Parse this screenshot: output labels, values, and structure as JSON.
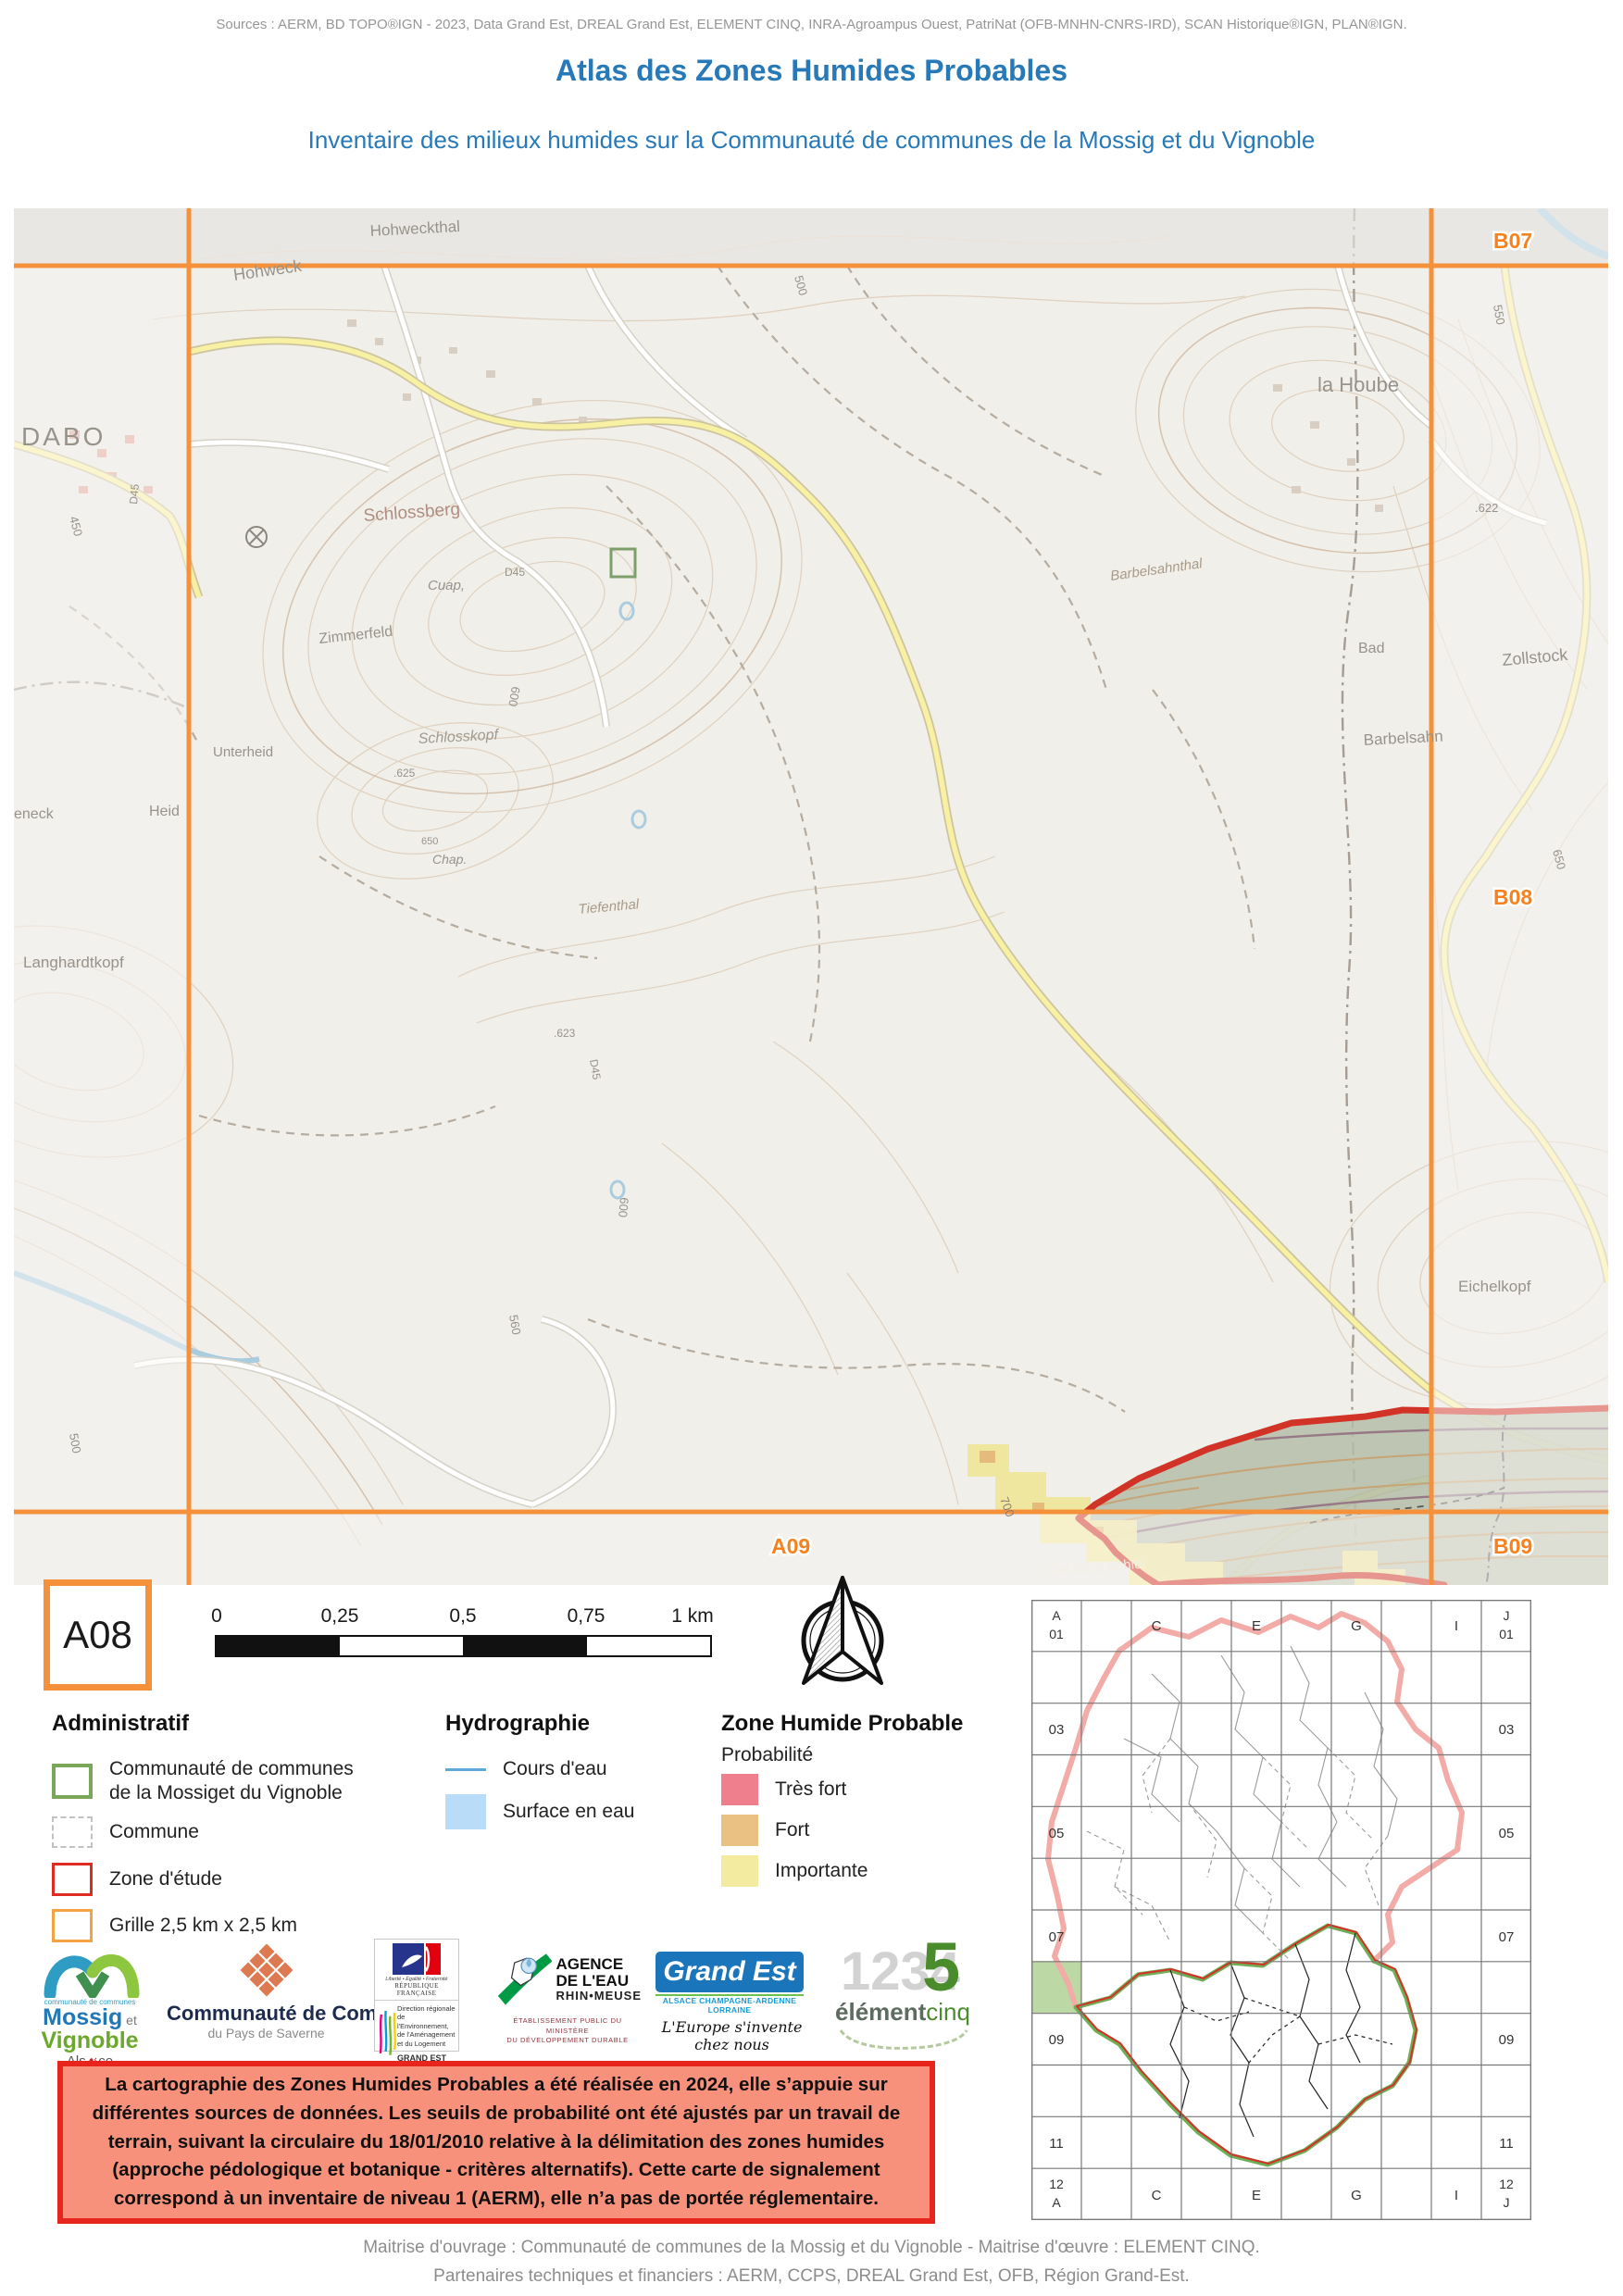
{
  "colors": {
    "accent_orange": "#F5913A",
    "title_blue": "#2779B7",
    "zone_etude_red": "#D23327",
    "cc_green": "#79A758",
    "proba_tres_fort": "#F07F8D",
    "proba_fort": "#EBC083",
    "proba_importante": "#F3ECA0",
    "surface_eau": "#B9DCF8",
    "cours_eau": "#5FA8D8",
    "note_bg": "#F8917B"
  },
  "header": {
    "sources": "Sources : AERM, BD TOPO®IGN - 2023, Data Grand Est, DREAL Grand Est, ELEMENT CINQ, INRA-Agroampus Ouest, PatriNat (OFB-MNHN-CNRS-IRD), SCAN Historique®IGN, PLAN®IGN.",
    "title": "Atlas des Zones Humides Probables",
    "subtitle": "Inventaire des milieux humides sur la Communauté de communes de la Mossig et du Vignoble"
  },
  "map": {
    "grid": [
      "B07",
      "B08",
      "B09",
      "A09"
    ],
    "labels": [
      "Hohweckthal",
      "Hohweck",
      "DABO",
      "la Hoube",
      "Schlossberg",
      "Cuap,",
      "Zimmerfeld",
      "D45",
      "Barbelsahnthal",
      "Bad",
      "Zollstock",
      ".622",
      "550",
      "500",
      "450",
      "D45",
      "Unterheid",
      "Schlosskopf",
      ".625",
      "Barbelsahn",
      "Tiefenthal",
      "Langhardtkopf",
      ".623",
      "D45",
      "600",
      "600",
      "560",
      "500",
      "650",
      "Eichelkopf",
      "700",
      "700",
      "Col de la Schlei",
      "eneck",
      "Heid",
      "Chap.",
      "650"
    ]
  },
  "panel": {
    "cell_id": "A08",
    "scalebar_ticks": [
      "0",
      "0,25",
      "0,5",
      "0,75",
      "1 km"
    ]
  },
  "legend": {
    "administratif": {
      "header": "Administratif",
      "item1_line1": "Communauté de communes",
      "item1_line2": "de la Mossiget du Vignoble",
      "item2": "Commune",
      "item3": "Zone d'étude",
      "item4": "Grille 2,5 km x 2,5 km"
    },
    "hydrographie": {
      "header": "Hydrographie",
      "item1": "Cours d'eau",
      "item2": "Surface en eau"
    },
    "zhp": {
      "header": "Zone Humide Probable",
      "sub": "Probabilité",
      "item1": "Très fort",
      "item2": "Fort",
      "item3": "Importante"
    }
  },
  "logos": {
    "mossig": {
      "cc": "communauté de communes",
      "name1": "Mossig",
      "et": " et ",
      "name2": "Vignoble",
      "region_pre": "Als",
      "region_o": "☙",
      "region_post": "ce"
    },
    "saverne": {
      "name": "Communauté de Communes",
      "sub": "du Pays de Saverne"
    },
    "dreal": {
      "motto": "Liberté • Égalité • Fraternité",
      "republique": "RÉPUBLIQUE FRANÇAISE",
      "l1": "Direction régionale",
      "l2": "de l'Environnement,",
      "l3": "de l'Aménagement",
      "l4": "et du Logement",
      "region": "GRAND EST"
    },
    "aerm": {
      "l1": "AGENCE",
      "l2": "DE L'EAU",
      "l3": "RHIN•MEUSE",
      "sub1": "ÉTABLISSEMENT PUBLIC DU MINISTÈRE",
      "sub2": "DU DÉVELOPPEMENT DURABLE"
    },
    "grandest": {
      "name": "Grand Est",
      "strip": "ALSACE CHAMPAGNE-ARDENNE LORRAINE",
      "tagline": "L'Europe s'invente chez nous"
    },
    "element5": {
      "digits": "1234",
      "five": "5",
      "name1": "élément",
      "name2": "cinq"
    }
  },
  "note": {
    "text": "La cartographie des Zones Humides Probables a été réalisée en 2024, elle s’appuie sur différentes sources de données. Les seuils de probabilité ont été ajustés par un travail de terrain, suivant la circulaire du 18/01/2010 relative à la délimitation des zones humides (approche pédologique et botanique - critères alternatifs). Cette carte de signalement correspond à un inventaire de niveau 1 (AERM), elle n’a pas de portée réglementaire."
  },
  "overview": {
    "corners": [
      "A",
      "01",
      "J",
      "01",
      "12",
      "A",
      "12",
      "J"
    ],
    "cols": [
      "C",
      "E",
      "G",
      "I"
    ],
    "rows": [
      "03",
      "05",
      "07",
      "09",
      "11"
    ]
  },
  "footer": {
    "line1": "Maitrise d'ouvrage : Communauté de communes de la Mossig et du Vignoble - Maitrise d'œuvre : ELEMENT CINQ.",
    "line2": "Partenaires techniques et financiers : AERM, CCPS, DREAL Grand Est, OFB, Région Grand-Est."
  }
}
